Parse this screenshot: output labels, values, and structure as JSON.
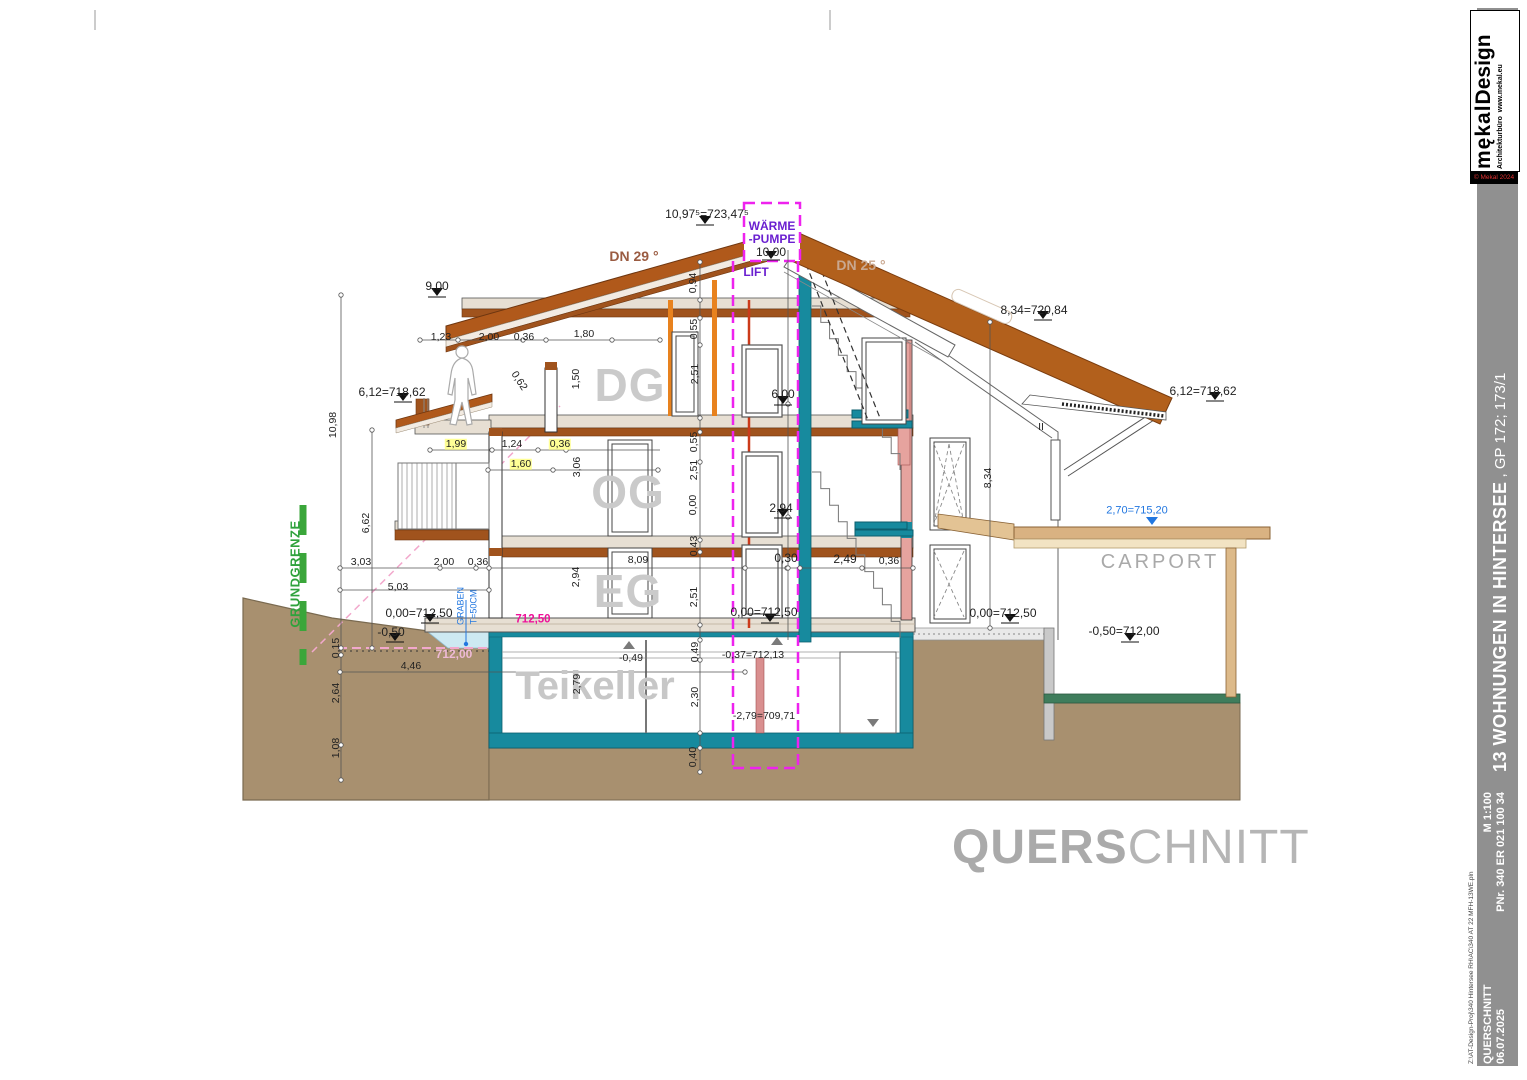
{
  "title": {
    "bold_part": "QUERS",
    "light_part": "CHNITT"
  },
  "sidebar": {
    "logo_brand_1": "mękal",
    "logo_brand_2": "Design",
    "logo_sub_1": "Architekturbüro",
    "logo_sub_2": "www.mekal.eu",
    "copyright": "© Mekal 2024",
    "project_title_bold": "13 WOHNUNGEN IN HINTERSEE",
    "project_title_rest": ", GP 172; 173/1",
    "doc_type": "QUERSCHNITT",
    "scale": "M 1:100",
    "date": "06.07.2025",
    "plan_no": "PNr. 340 ER 021 100 34",
    "file_path": "Z:\\AT-Design-Proj\\340 Hintersee RH\\AC\\340 AT 22 MFH-13WE.pln"
  },
  "colors": {
    "roof": "#b2601c",
    "teal": "#178a9e",
    "magenta": "#ee22ee",
    "purple": "#6a1fd0",
    "green": "#2fa23c",
    "blue": "#2277e0",
    "ground": "#a8906f",
    "wood": "#d9b282",
    "salmon": "#e6a39e",
    "level-magenta": "#ee1199",
    "slab-brown": "#a0531d"
  },
  "drawing": {
    "labels": [
      {
        "n": "ridge-level",
        "t": "10,97⁵=723,47⁵",
        "x": 707,
        "y": 214,
        "c": "dl"
      },
      {
        "n": "heatpump-line1",
        "t": "WÄRME",
        "x": 772,
        "y": 226,
        "c": "pu"
      },
      {
        "n": "heatpump-line2",
        "t": "-PUMPE",
        "x": 772,
        "y": 239,
        "c": "pu"
      },
      {
        "n": "heatpump-level",
        "t": "10,00",
        "x": 771,
        "y": 252,
        "c": "dl"
      },
      {
        "n": "roof-pitch-left",
        "t": "DN 29 °",
        "x": 634,
        "y": 256,
        "c": "r1"
      },
      {
        "n": "roof-pitch-right",
        "t": "DN 25 °",
        "x": 861,
        "y": 265,
        "c": "r2"
      },
      {
        "n": "eave-level-left-top",
        "t": "9,00",
        "x": 437,
        "y": 286,
        "c": "dl"
      },
      {
        "n": "lift-label",
        "t": "LIFT",
        "x": 756,
        "y": 272,
        "c": "pu"
      },
      {
        "n": "level-834",
        "t": "8,34=720,84",
        "x": 1034,
        "y": 310,
        "c": "dl"
      },
      {
        "n": "level-612-left",
        "t": "6,12=718,62",
        "x": 392,
        "y": 392,
        "c": "dl"
      },
      {
        "n": "level-612-right",
        "t": "6,12=718,62",
        "x": 1203,
        "y": 391,
        "c": "dl"
      },
      {
        "n": "dim-1098",
        "t": "10,98",
        "x": 333,
        "y": 425,
        "c": "v"
      },
      {
        "n": "dim-123",
        "t": "1,23",
        "x": 441,
        "y": 337,
        "c": "d"
      },
      {
        "n": "dim-200-dg",
        "t": "2,00",
        "x": 489,
        "y": 337,
        "c": "d"
      },
      {
        "n": "dim-036-dg",
        "t": "0,36",
        "x": 524,
        "y": 337,
        "c": "d"
      },
      {
        "n": "dim-180",
        "t": "1,80",
        "x": 584,
        "y": 334,
        "c": "d"
      },
      {
        "n": "dim-094",
        "t": "0,94",
        "x": 693,
        "y": 283,
        "c": "v"
      },
      {
        "n": "dim-055-top",
        "t": "0,55",
        "x": 694,
        "y": 329,
        "c": "v"
      },
      {
        "n": "dim-251-dg",
        "t": "2,51",
        "x": 695,
        "y": 374,
        "c": "v"
      },
      {
        "n": "dim-150",
        "t": "1,50",
        "x": 576,
        "y": 379,
        "c": "v"
      },
      {
        "n": "floor-label-dg",
        "t": "DG",
        "x": 630,
        "y": 385,
        "c": "fl"
      },
      {
        "n": "dim-062-slope",
        "t": "0,62",
        "x": 519,
        "y": 381,
        "c": "d57"
      },
      {
        "n": "level-600",
        "t": "6,00",
        "x": 783,
        "y": 394,
        "c": "dl"
      },
      {
        "n": "dim-199",
        "t": "1,99",
        "x": 456,
        "y": 444,
        "c": "d y"
      },
      {
        "n": "dim-124",
        "t": "1,24",
        "x": 512,
        "y": 444,
        "c": "d"
      },
      {
        "n": "dim-036-og",
        "t": "0,36",
        "x": 560,
        "y": 444,
        "c": "d y"
      },
      {
        "n": "dim-160",
        "t": "1,60",
        "x": 521,
        "y": 464,
        "c": "d y"
      },
      {
        "n": "dim-306",
        "t": "3,06",
        "x": 577,
        "y": 467,
        "c": "v"
      },
      {
        "n": "dim-055-og",
        "t": "0,55",
        "x": 694,
        "y": 442,
        "c": "v"
      },
      {
        "n": "dim-251-og",
        "t": "2,51",
        "x": 694,
        "y": 470,
        "c": "v"
      },
      {
        "n": "dim-000-og",
        "t": "0,00",
        "x": 693,
        "y": 505,
        "c": "v"
      },
      {
        "n": "floor-label-og",
        "t": "OG",
        "x": 628,
        "y": 492,
        "c": "fl"
      },
      {
        "n": "dim-662",
        "t": "6,62",
        "x": 366,
        "y": 523,
        "c": "v"
      },
      {
        "n": "level-294",
        "t": "2,94",
        "x": 781,
        "y": 508,
        "c": "dl"
      },
      {
        "n": "dim-043",
        "t": "0,43",
        "x": 694,
        "y": 546,
        "c": "v"
      },
      {
        "n": "dim-303",
        "t": "3,03",
        "x": 361,
        "y": 562,
        "c": "d"
      },
      {
        "n": "dim-200-eg",
        "t": "2,00",
        "x": 444,
        "y": 562,
        "c": "d"
      },
      {
        "n": "dim-036-eg",
        "t": "0,36",
        "x": 478,
        "y": 562,
        "c": "d"
      },
      {
        "n": "dim-809",
        "t": "8,09",
        "x": 638,
        "y": 560,
        "c": "d"
      },
      {
        "n": "dim-030",
        "t": "0,30",
        "x": 786,
        "y": 558,
        "c": "dl"
      },
      {
        "n": "dim-249",
        "t": "2,49",
        "x": 845,
        "y": 559,
        "c": "dl"
      },
      {
        "n": "dim-036-stair",
        "t": "0,36",
        "x": 889,
        "y": 561,
        "c": "d"
      },
      {
        "n": "dim-294-eg",
        "t": "2,94",
        "x": 576,
        "y": 577,
        "c": "v"
      },
      {
        "n": "dim-251-eg",
        "t": "2,51",
        "x": 694,
        "y": 597,
        "c": "v"
      },
      {
        "n": "floor-label-eg",
        "t": "EG",
        "x": 628,
        "y": 591,
        "c": "fl"
      },
      {
        "n": "dim-834",
        "t": "8,34",
        "x": 988,
        "y": 478,
        "c": "v"
      },
      {
        "n": "dim-503",
        "t": "5,03",
        "x": 398,
        "y": 587,
        "c": "d"
      },
      {
        "n": "level-000-left",
        "t": "0,00=712,50",
        "x": 419,
        "y": 613,
        "c": "dl"
      },
      {
        "n": "graben-label-1",
        "t": "GRABEN",
        "x": 461,
        "y": 606,
        "c": "bls"
      },
      {
        "n": "graben-label-2",
        "t": "T=50CM",
        "x": 474,
        "y": 607,
        "c": "bls"
      },
      {
        "n": "level-71250",
        "t": "712,50",
        "x": 533,
        "y": 620,
        "c": "mg"
      },
      {
        "n": "level-minus050",
        "t": "-0,50",
        "x": 391,
        "y": 632,
        "c": "dl"
      },
      {
        "n": "level-71200",
        "t": "712,00",
        "x": 454,
        "y": 654,
        "c": "pk"
      },
      {
        "n": "dim-015",
        "t": "0,15",
        "x": 336,
        "y": 648,
        "c": "v"
      },
      {
        "n": "dim-446",
        "t": "4,46",
        "x": 411,
        "y": 666,
        "c": "d"
      },
      {
        "n": "dim-264",
        "t": "2,64",
        "x": 336,
        "y": 693,
        "c": "v"
      },
      {
        "n": "dim-108",
        "t": "1,08",
        "x": 336,
        "y": 748,
        "c": "v"
      },
      {
        "n": "grundgrenze-label",
        "t": "GRUNDGRENZE",
        "x": 295,
        "y": 574,
        "c": "gr"
      },
      {
        "n": "floor-label-keller",
        "t": "Teikeller",
        "x": 595,
        "y": 686,
        "c": "flk"
      },
      {
        "n": "dim-279",
        "t": "2,79",
        "x": 577,
        "y": 684,
        "c": "v"
      },
      {
        "n": "level-minus049",
        "t": "-0,49",
        "x": 631,
        "y": 658,
        "c": "d"
      },
      {
        "n": "dim-049",
        "t": "0,49",
        "x": 695,
        "y": 652,
        "c": "v"
      },
      {
        "n": "level-minus037",
        "t": "-0,37=712,13",
        "x": 753,
        "y": 655,
        "c": "d"
      },
      {
        "n": "dim-230",
        "t": "2,30",
        "x": 695,
        "y": 697,
        "c": "v"
      },
      {
        "n": "level-minus279",
        "t": "-2,79=709,71",
        "x": 764,
        "y": 716,
        "c": "d"
      },
      {
        "n": "dim-040",
        "t": "0,40",
        "x": 693,
        "y": 757,
        "c": "v"
      },
      {
        "n": "level-000-mid",
        "t": "0,00=712,50",
        "x": 764,
        "y": 612,
        "c": "dl"
      },
      {
        "n": "level-000-right",
        "t": "0,00=712,50",
        "x": 1003,
        "y": 613,
        "c": "dl"
      },
      {
        "n": "carport-roof-level",
        "t": "2,70=715,20",
        "x": 1137,
        "y": 511,
        "c": "bl"
      },
      {
        "n": "carport-label",
        "t": "CARPORT",
        "x": 1160,
        "y": 562,
        "c": "cp"
      },
      {
        "n": "carport-ground-level",
        "t": "-0,50=712,00",
        "x": 1124,
        "y": 631,
        "c": "dl"
      },
      {
        "n": "parallel-mark",
        "t": "II",
        "x": 1041,
        "y": 427,
        "c": "d"
      }
    ]
  }
}
